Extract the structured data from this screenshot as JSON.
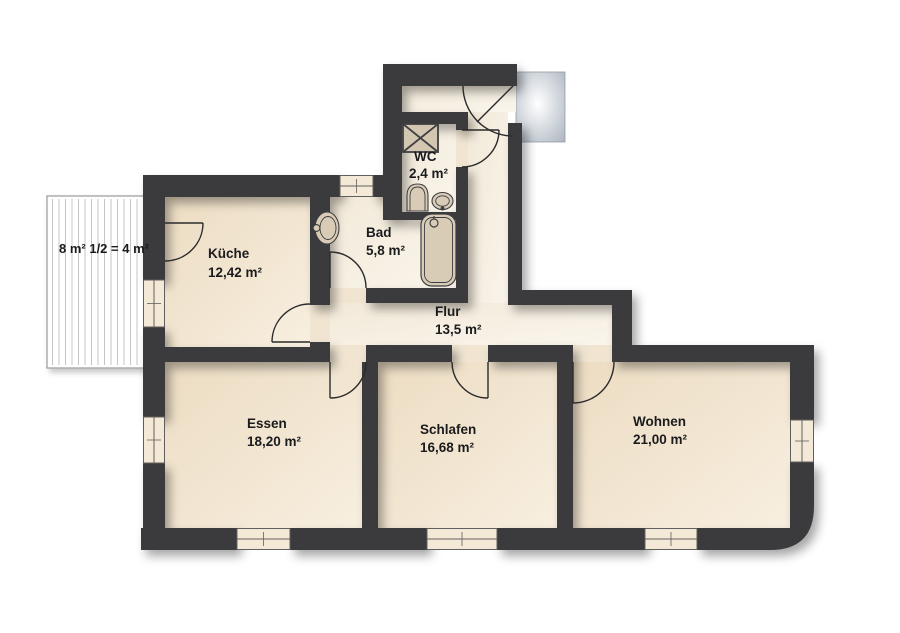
{
  "plan": {
    "balcony": {
      "label": "8 m² 1/2 = 4 m²"
    },
    "rooms": [
      {
        "id": "kueche",
        "name": "Küche",
        "area": "12,42 m²"
      },
      {
        "id": "wc",
        "name": "WC",
        "area": "2,4 m²"
      },
      {
        "id": "bad",
        "name": "Bad",
        "area": "5,8 m²"
      },
      {
        "id": "flur",
        "name": "Flur",
        "area": "13,5 m²"
      },
      {
        "id": "essen",
        "name": "Essen",
        "area": "18,20 m²"
      },
      {
        "id": "schlafen",
        "name": "Schlafen",
        "area": "16,68 m²"
      },
      {
        "id": "wohnen",
        "name": "Wohnen",
        "area": "21,00 m²"
      }
    ],
    "colors": {
      "wall": "#3a3a3c",
      "room_fill": "#efe0c9",
      "hall_fill": "#f6efe2",
      "fixture_fill": "#d9ccb6",
      "landing_gray": "#aeb7c2",
      "balcony_hatch": "#c4c4c4"
    }
  }
}
